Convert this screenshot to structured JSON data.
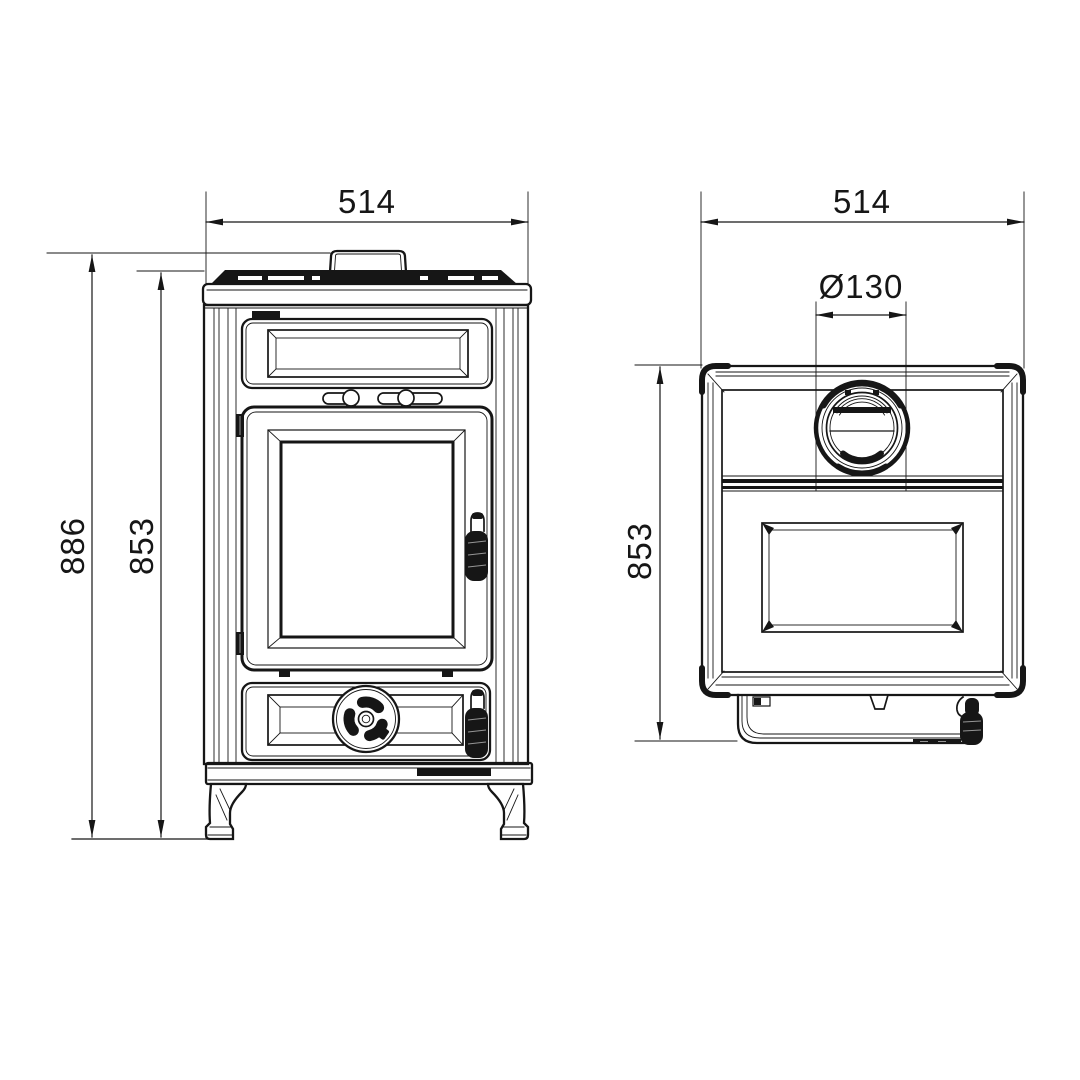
{
  "drawing": {
    "kind": "stove-dimension-drawing",
    "ink": "#161616",
    "paper": "#ffffff",
    "front_view": {
      "width_mm": "514",
      "overall_height_mm": "886",
      "body_height_mm": "853"
    },
    "top_view": {
      "width_mm": "514",
      "flue_diameter_mm": "Ø130",
      "height_mm": "853"
    }
  }
}
